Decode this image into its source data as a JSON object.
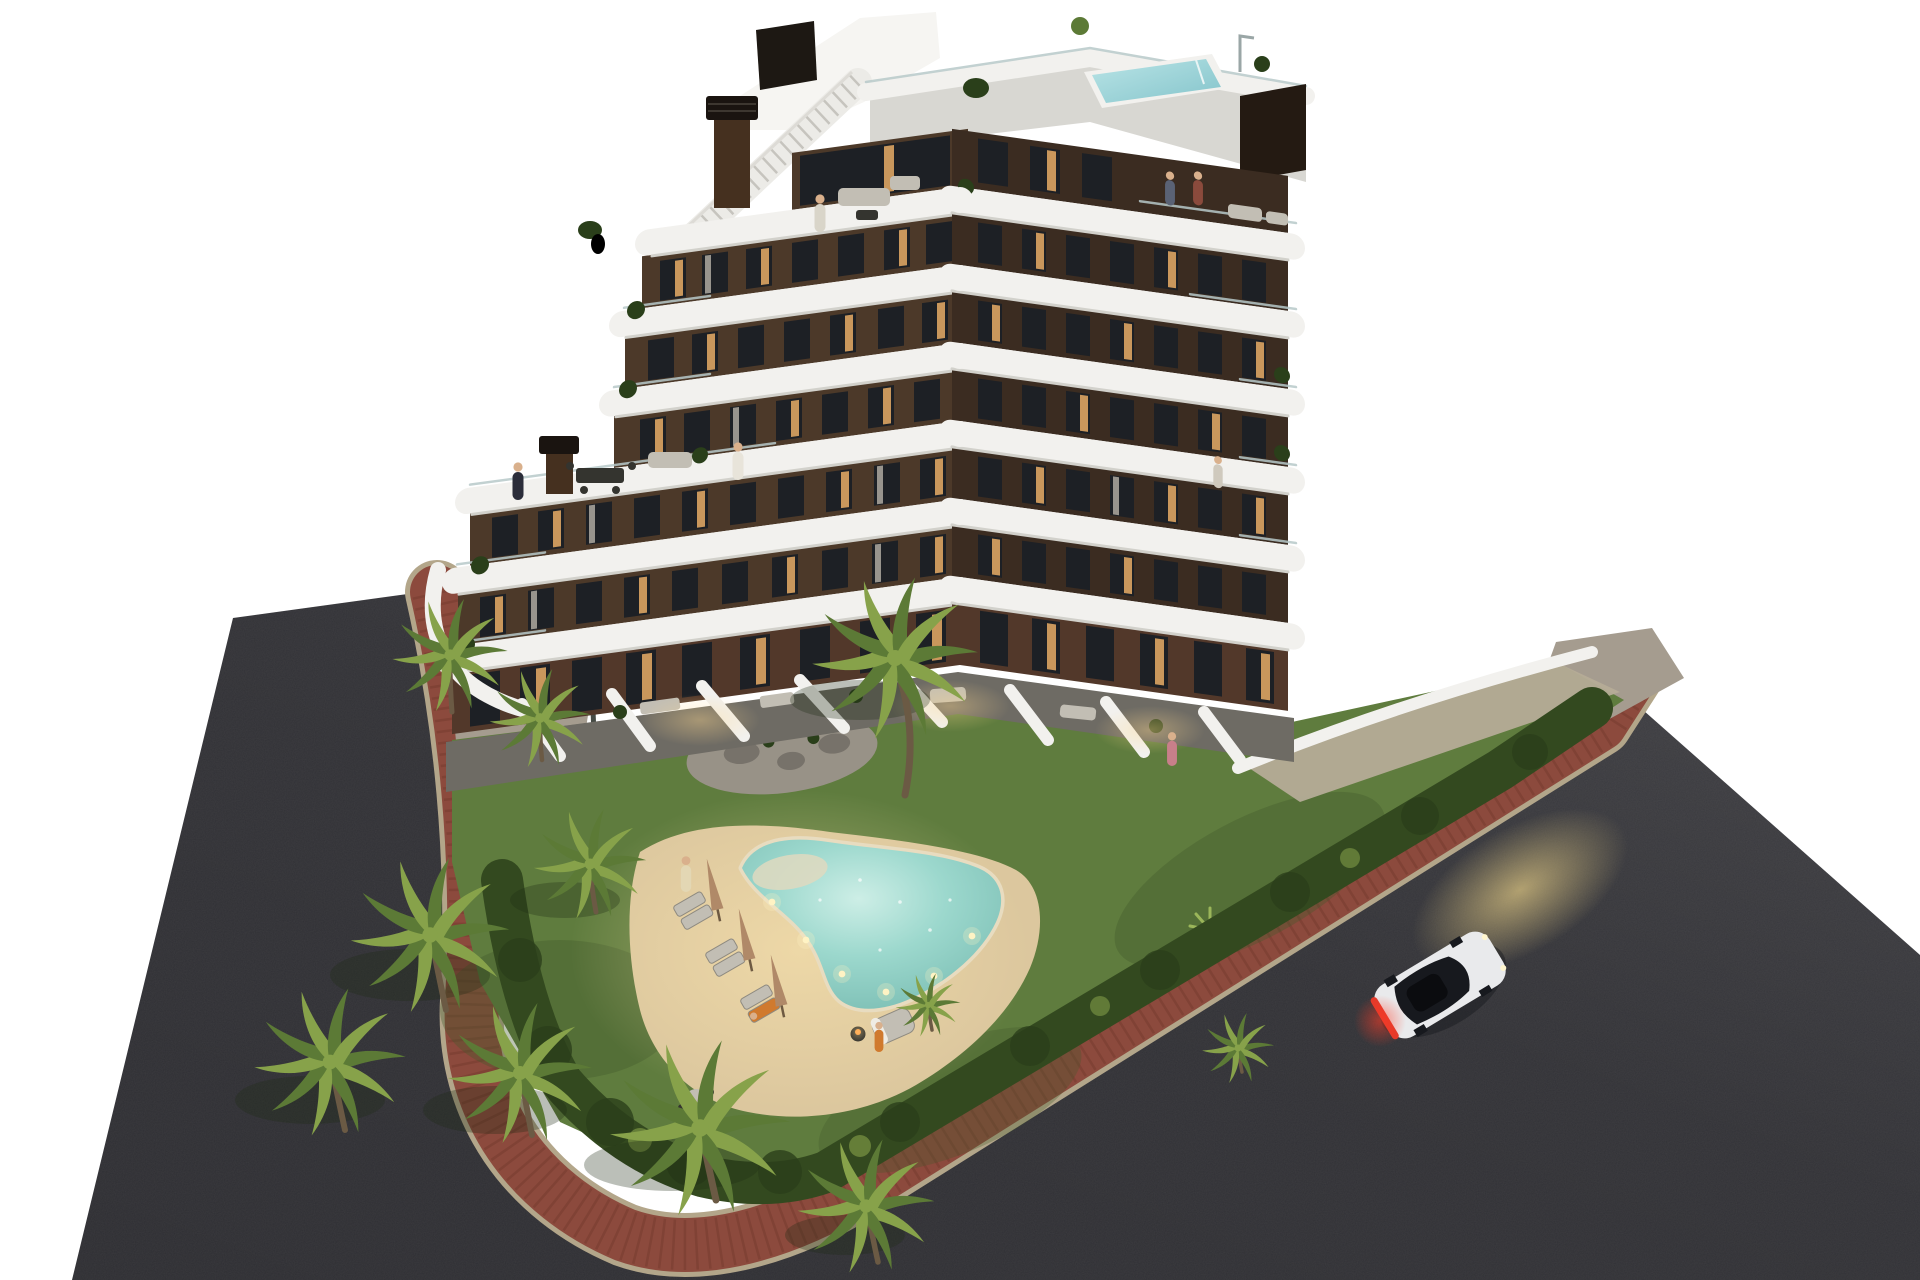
{
  "scene": {
    "type": "architectural-3d-render",
    "time_of_day": "dusk, windows and pool lights glowing",
    "background": "plain white cut-out",
    "building": {
      "floors_visible": 7,
      "massing": "stepped corner tower, curved white balcony bands wrapping dark brown facades",
      "windows_lit": true,
      "chimneys": 2,
      "rooftop": {
        "plunge_pool": true,
        "outdoor_shower": true,
        "stair_access": true,
        "glass_parapet": true
      },
      "penthouse_terrace": {
        "stairs_to_roof": true,
        "lounge_set": true,
        "people": 1
      },
      "side_terraces_with_people": 2
    },
    "amenities": {
      "lagoon_pool": {
        "shape": "freeform boomerang",
        "beach_entry": true,
        "underwater_lights": 6
      },
      "sun_lounger_pairs": 3,
      "closed_parasols": 3,
      "double_lounger": 1,
      "fire_bowl": 1,
      "outdoor_dining_set": 1,
      "planted_rock_island": 1
    },
    "landscape": {
      "palm_trees_large": 9,
      "palm_trees_small": 2,
      "perimeter_hedge": true,
      "lawn": true,
      "entry_courtyards": 2
    },
    "streets": {
      "asphalt_roads": 2,
      "sidewalk": "red clay brick band with stone curbs wrapping the corner plot",
      "car": {
        "color": "white",
        "type": "coupe",
        "headlights_on": true,
        "tail_light_bar": "red"
      }
    },
    "people_total": 10
  },
  "palette": {
    "bg": "#ffffff",
    "asphalt": "#2e2e33",
    "court": "#a59c8f",
    "gravel": "#b5ac97",
    "brick": "#8c4a3d",
    "brickDark": "#73392e",
    "curb": "#b3a68a",
    "grass": "#5f7c3e",
    "grassDark": "#42592c",
    "hedge": "#33491f",
    "hedgeDark": "#2a3f1a",
    "palm": "#5c7a36",
    "palmLight": "#87a24a",
    "trunk": "#6b5a44",
    "sand": "#dcc79e",
    "poolWater": "#8fcfc6",
    "poolShallow": "#dfd9bf",
    "coping": "#e8dcc0",
    "bandWhite": "#f2f1ee",
    "bandShade": "#d2d1cb",
    "glassRail": "#b7c9c9",
    "facadeLeft": "#4c3929",
    "facadeRight": "#3b2c21",
    "facadeGround": "#52382a",
    "apron": "#6e6b64",
    "window": "#1d2025",
    "windowLit": "#c9975c",
    "curtain": "#b8b2a8",
    "roofDeck": "#d8d7d2",
    "roofPool": "#9ed6da",
    "chimney": "#45301f",
    "chimneyCap": "#1a1410",
    "carBody": "#e9eaec",
    "carGlass": "#17191e",
    "tailLight": "#e23a2a",
    "headGlow": "#e6cb82",
    "skin": "#d9b08c",
    "furnGray": "#c2beb4",
    "furnDark": "#34342f",
    "pebble": "#989287",
    "boulder": "#77726a"
  }
}
